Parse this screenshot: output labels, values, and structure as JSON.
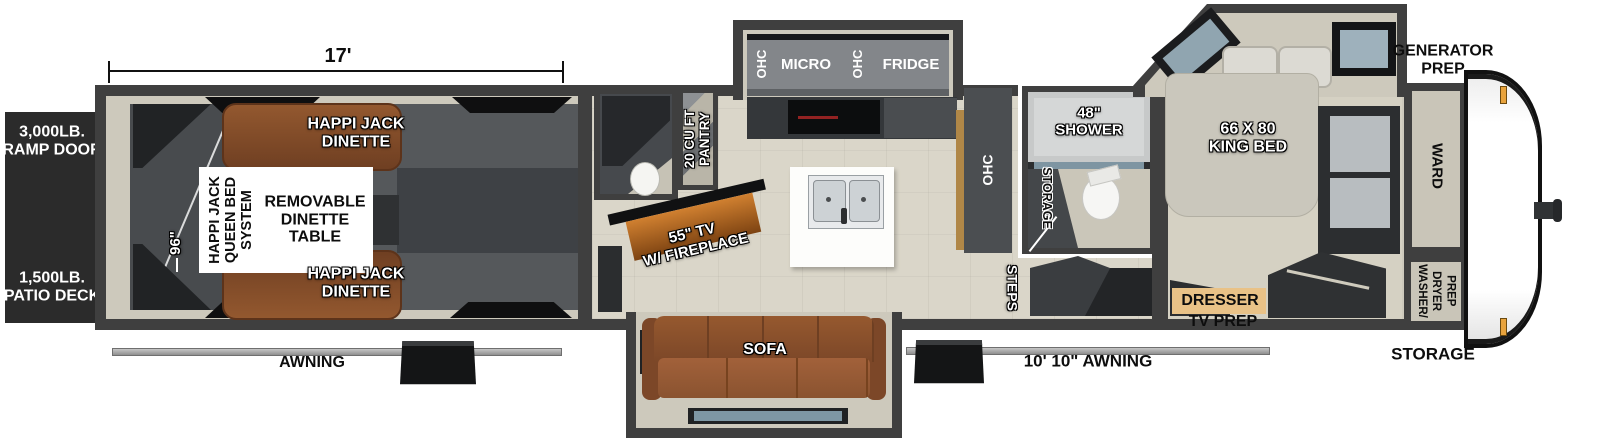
{
  "colors": {
    "wall_gray": "#3f3f3f",
    "interior_beige": "#cdc9bc",
    "garage_floor": "#55585b",
    "sofa_brown": "#8a5330",
    "dresser_tan": "#e9c287",
    "fireplace_glow": "#c87a28",
    "window_glass": "#93a8b3",
    "cap_white": "#ffffff",
    "marker_light": "#e8a33d"
  },
  "dimensions": {
    "garage_length": "17'",
    "garage_width": "96\""
  },
  "exterior": {
    "ramp_door": "3,000LB.\nRAMP DOOR",
    "patio_deck": "1,500LB.\nPATIO DECK",
    "generator_prep": "GENERATOR\nPREP",
    "front_storage": "STORAGE",
    "rear_awning": "AWNING",
    "main_awning": "10' 10\" AWNING"
  },
  "garage": {
    "dinette_front": "HAPPI JACK\nDINETTE",
    "dinette_rear": "HAPPI JACK\nDINETTE",
    "queen_bed_system": "HAPPI JACK\nQUEEN BED\nSYSTEM",
    "dinette_table": "REMOVABLE\nDINETTE\nTABLE"
  },
  "kitchen": {
    "ohc_left": "OHC",
    "micro": "MICRO",
    "ohc_right": "OHC",
    "fridge": "FRIDGE",
    "pantry": "20 CU FT\nPANTRY",
    "ohc_cabinet": "OHC"
  },
  "living": {
    "tv_fireplace": "55\" TV\nW/ FIREPLACE",
    "sofa": "SOFA"
  },
  "bathroom": {
    "shower": "48\"\nSHOWER",
    "storage": "STORAGE"
  },
  "entry": {
    "steps": "STEPS"
  },
  "bedroom": {
    "king_bed": "66 X 80\nKING BED",
    "dresser": "DRESSER",
    "tv_prep": "TV PREP",
    "ward": "WARD",
    "washer_dryer_prep": "WASHER/\nDRYER\nPREP"
  }
}
